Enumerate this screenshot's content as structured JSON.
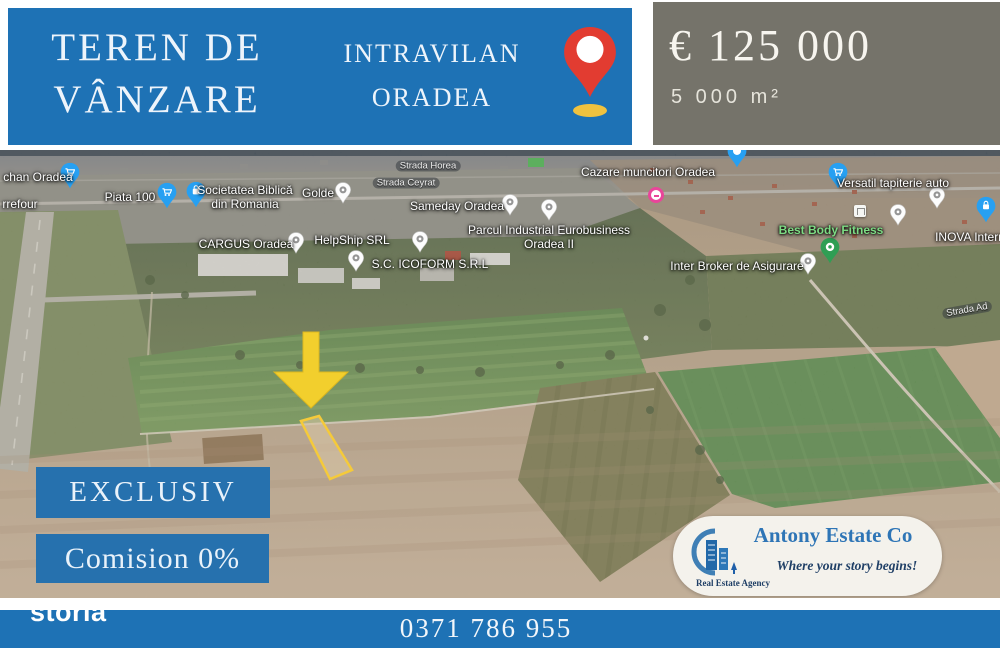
{
  "banner": {
    "title_line1": "TEREN DE",
    "title_line2": "VÂNZARE",
    "subtitle_line1": "INTRAVILAN",
    "subtitle_line2": "ORADEA"
  },
  "price": {
    "amount": "€ 125 000",
    "area": "5 000 m²"
  },
  "badges": {
    "exclusive": "EXCLUSIV",
    "commission": "Comision 0%"
  },
  "agency": {
    "name": "Antony Estate Co",
    "tagline": "Where your story begins!",
    "label": "Real Estate Agency"
  },
  "footer": {
    "phone": "0371 786 955",
    "watermark": "storia"
  },
  "map": {
    "labels": [
      {
        "text": "chan Oradea"
      },
      {
        "text": "rrefour"
      },
      {
        "text": "Piata 100"
      },
      {
        "text": "Societatea Biblică din Romania"
      },
      {
        "text": "Golde"
      },
      {
        "text": "Strada Horea"
      },
      {
        "text": "Strada Ceyrat"
      },
      {
        "text": "Sameday Oradea"
      },
      {
        "text": "CARGUS Oradea"
      },
      {
        "text": "HelpShip SRL"
      },
      {
        "text": "S.C. ICOFORM S.R.L"
      },
      {
        "text": "Parcul Industrial Eurobusiness Oradea II"
      },
      {
        "text": "Cazare muncitori Oradea"
      },
      {
        "text": "Versatil tapiterie auto"
      },
      {
        "text": "Best Body Fitness"
      },
      {
        "text": "INOVA Internat"
      },
      {
        "text": "Inter Broker de Asigurare"
      },
      {
        "text": "Strada Ad"
      }
    ],
    "pins": [
      {
        "name": "shopping-cart-pin",
        "color": "#27a0f2"
      },
      {
        "name": "shopping-bag-pin",
        "color": "#27a0f2"
      },
      {
        "name": "lock-pin",
        "color": "#27a0f2"
      },
      {
        "name": "place-pin-gray",
        "color": "#ffffff"
      },
      {
        "name": "fitness-pin",
        "color": "#2f9e54"
      },
      {
        "name": "pink-poi",
        "color": "#e9459a"
      },
      {
        "name": "location-pin",
        "color": "#e23c31"
      }
    ]
  },
  "colors": {
    "banner_blue": "#1e72b5",
    "ribbon_blue": "#2671ae",
    "price_gray": "#75736a",
    "accent_yellow": "#f2cf2d",
    "pin_red": "#e23c31",
    "agency_blue": "#2e75b6"
  }
}
